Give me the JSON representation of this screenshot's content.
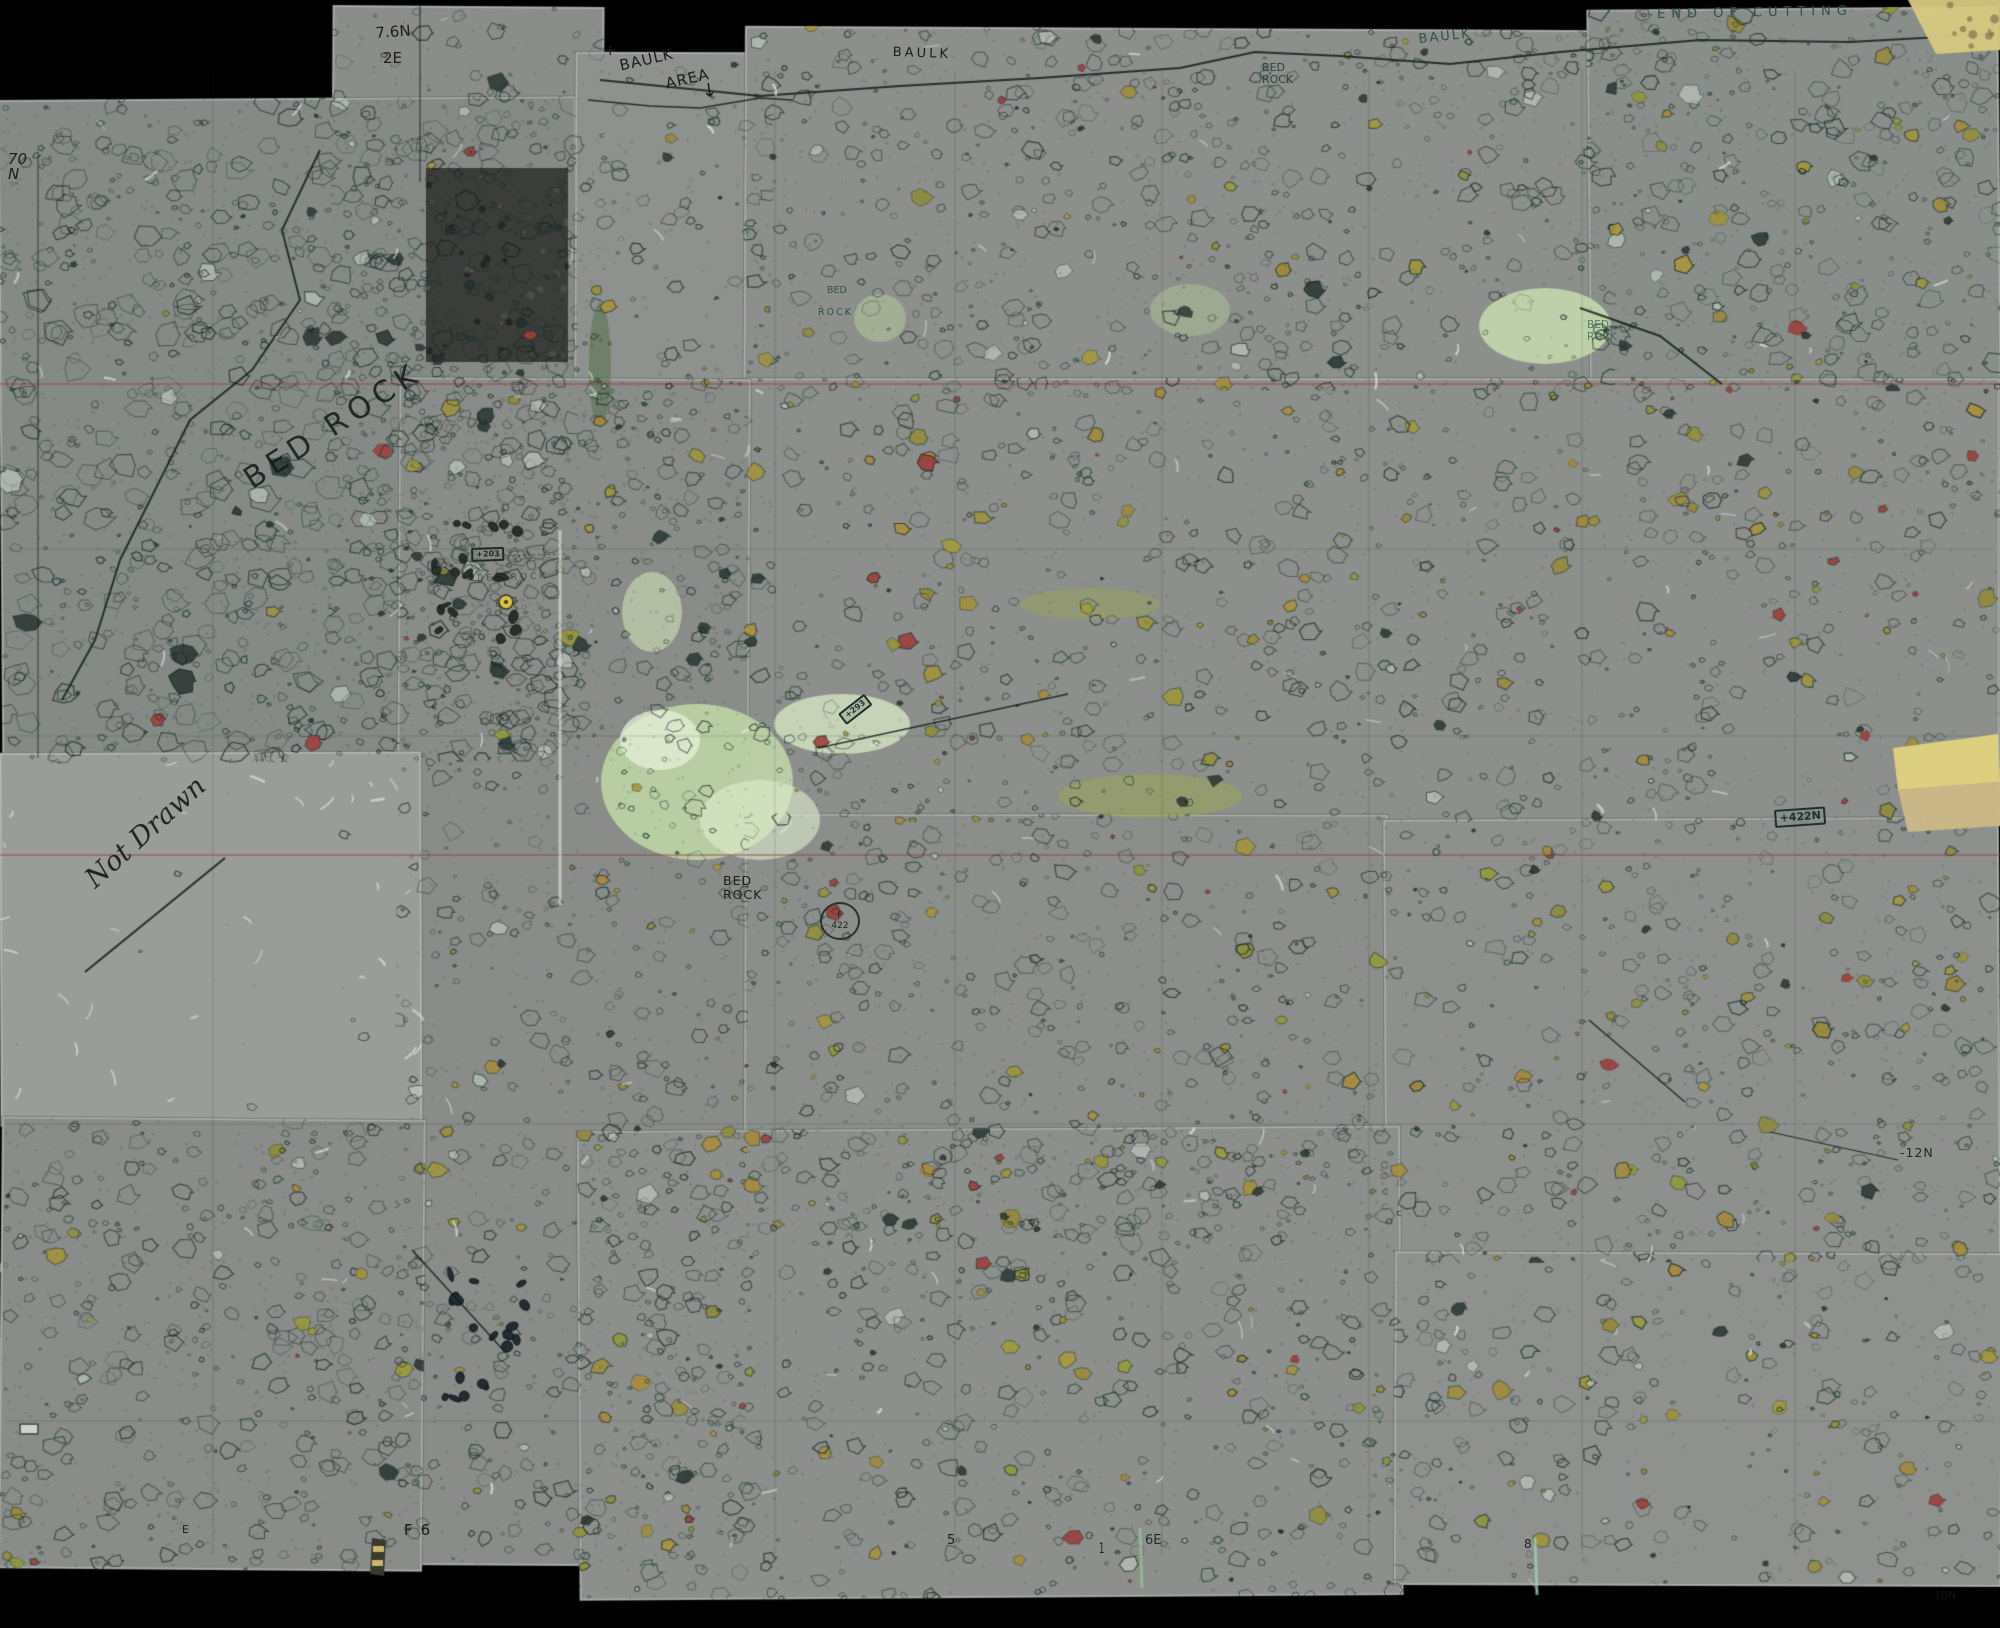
{
  "drawing": {
    "kind": "excavation plan mosaic",
    "colors": {
      "paper_gray": "#8b8e8a",
      "ink_teal": "#2c524a",
      "ink_black": "#1c1c1c",
      "olive_stone": "#9a9140",
      "red_stone": "#9e3f3c",
      "green_wash": "#c2d8a8",
      "datum_line_red": "#96423c",
      "tape_tan": "#d7c97f",
      "background": "#000000"
    }
  },
  "annotations": {
    "end_of_cutting": {
      "text": "END OF CUTTING"
    },
    "baulk_right": {
      "text": "BAULK"
    },
    "baulk_center": {
      "text": "BAULK"
    },
    "baulk_area_line1": {
      "text": "BAULK"
    },
    "baulk_area_line2": {
      "text": "AREA"
    },
    "baulk_area_arrow": {
      "text": "↓"
    },
    "plus_mark": {
      "text": "+"
    },
    "bed_rock_top": {
      "text": "BED\nROCK"
    },
    "grid_76n": {
      "text": "7.6N"
    },
    "grid_2e": {
      "text": "2E"
    },
    "grid_70n": {
      "text": "70\nN"
    },
    "bed_rock_script": {
      "text": "BED ROCK"
    },
    "bed_rock_small_bed": {
      "text": "BED"
    },
    "bed_rock_small_rock": {
      "text": "ROCK"
    },
    "bed_rock_right": {
      "text": "BED\nROCK"
    },
    "not_drawn": {
      "text": "Not Drawn"
    },
    "bed_rock_center": {
      "text": "BED\nROCK"
    },
    "find_f422": {
      "text": "F\n422"
    },
    "tag_422n": {
      "text": "+422N"
    },
    "tag_293": {
      "text": "+293"
    },
    "tag_203": {
      "text": "+203"
    },
    "bed_rock_faint": {
      "text": "BED ROCK"
    },
    "grid_f6": {
      "text": "F6"
    },
    "tick_5": {
      "text": "5"
    },
    "tick_1": {
      "text": "1"
    },
    "tick_6e": {
      "text": "6E"
    },
    "tick_8": {
      "text": "8"
    },
    "grid_12n": {
      "text": "-12N"
    },
    "grid_10n": {
      "text": "10N"
    },
    "grid_e": {
      "text": "E"
    }
  }
}
